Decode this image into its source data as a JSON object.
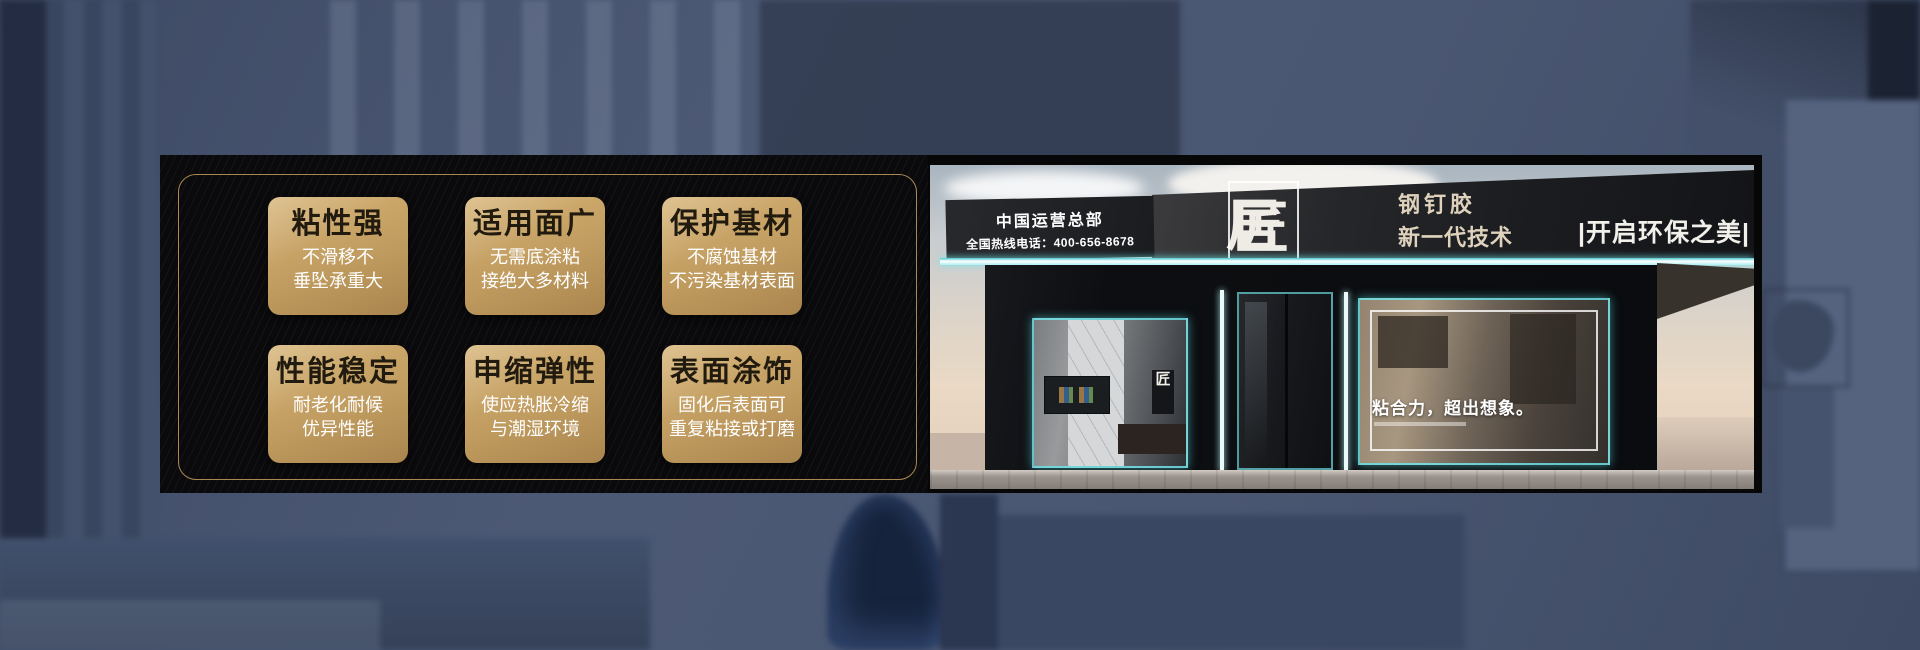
{
  "banner": {
    "features": [
      {
        "title": "粘性强",
        "desc": "不滑移不\n垂坠承重大"
      },
      {
        "title": "适用面广",
        "desc": "无需底涂粘\n接绝大多材料"
      },
      {
        "title": "保护基材",
        "desc": "不腐蚀基材\n不污染基材表面"
      },
      {
        "title": "性能稳定",
        "desc": "耐老化耐候\n优异性能"
      },
      {
        "title": "申缩弹性",
        "desc": "使应热胀冷缩\n与潮湿环境"
      },
      {
        "title": "表面涂饰",
        "desc": "固化后表面可\n重复粘接或打磨"
      }
    ]
  },
  "storefront": {
    "operator_line1": "中国运营总部",
    "operator_line2": "全国热线电话：400-656-8678",
    "brand_first": "居美",
    "brand_box": "匠",
    "product": "钢钉胶",
    "tech_line": "新一代技术",
    "right_slogan": "|开启环保之美|",
    "window_logo": "匠",
    "window_slogan": "粘合力，超出想象。"
  },
  "colors": {
    "card_gold_top": "#d5b274",
    "card_gold_bottom": "#a9854e",
    "gold_border": "#aa8852",
    "led_cyan": "#49c9ce",
    "panel_black": "#0a0a0c",
    "background_blue": "#4a5772"
  }
}
